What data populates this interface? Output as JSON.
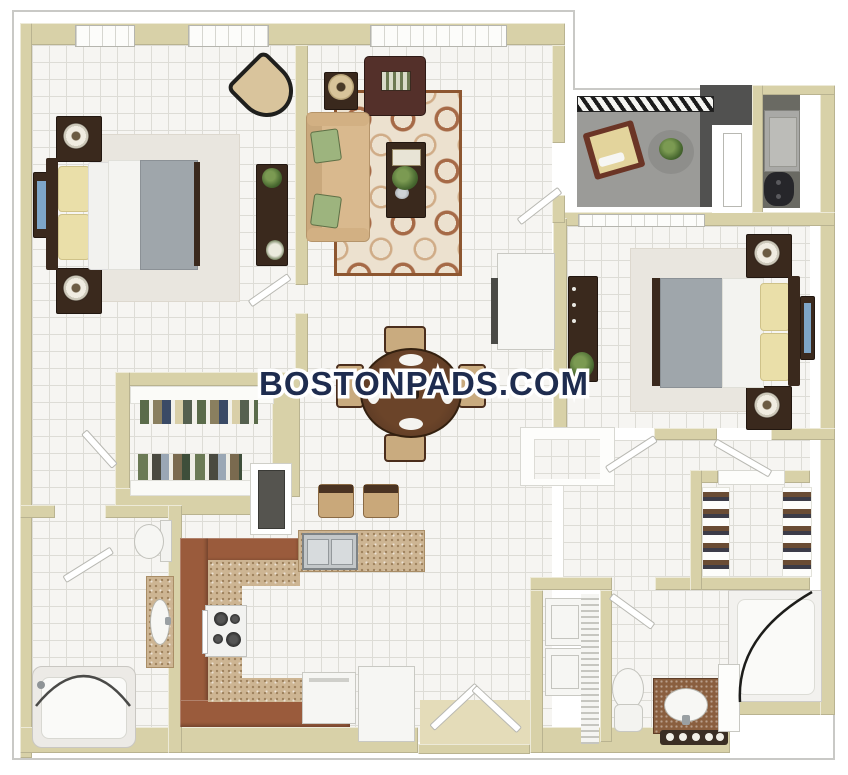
{
  "watermark": {
    "text": "BOSTONPADS.COM"
  },
  "colors": {
    "navy": "#1e2c4f",
    "wall": "#d8d1a8",
    "tile": "#f6f5f2",
    "grout": "#dddcd6",
    "wood": "#3a291d",
    "cabinet": "#9a5b3c",
    "counter": "#cdb593",
    "rug": "#ece1cf",
    "sofa": "#d9b98e",
    "armchair": "#54302a",
    "duvet": "#9fa6ab",
    "pillow": "#eadfa9",
    "balcony_floor": "#9b9b98",
    "balcony_wall": "#515150",
    "appliance": "#a9a9a6",
    "screen_blue": "#7ea6c8",
    "outline_gray": "#c9c9c6"
  }
}
